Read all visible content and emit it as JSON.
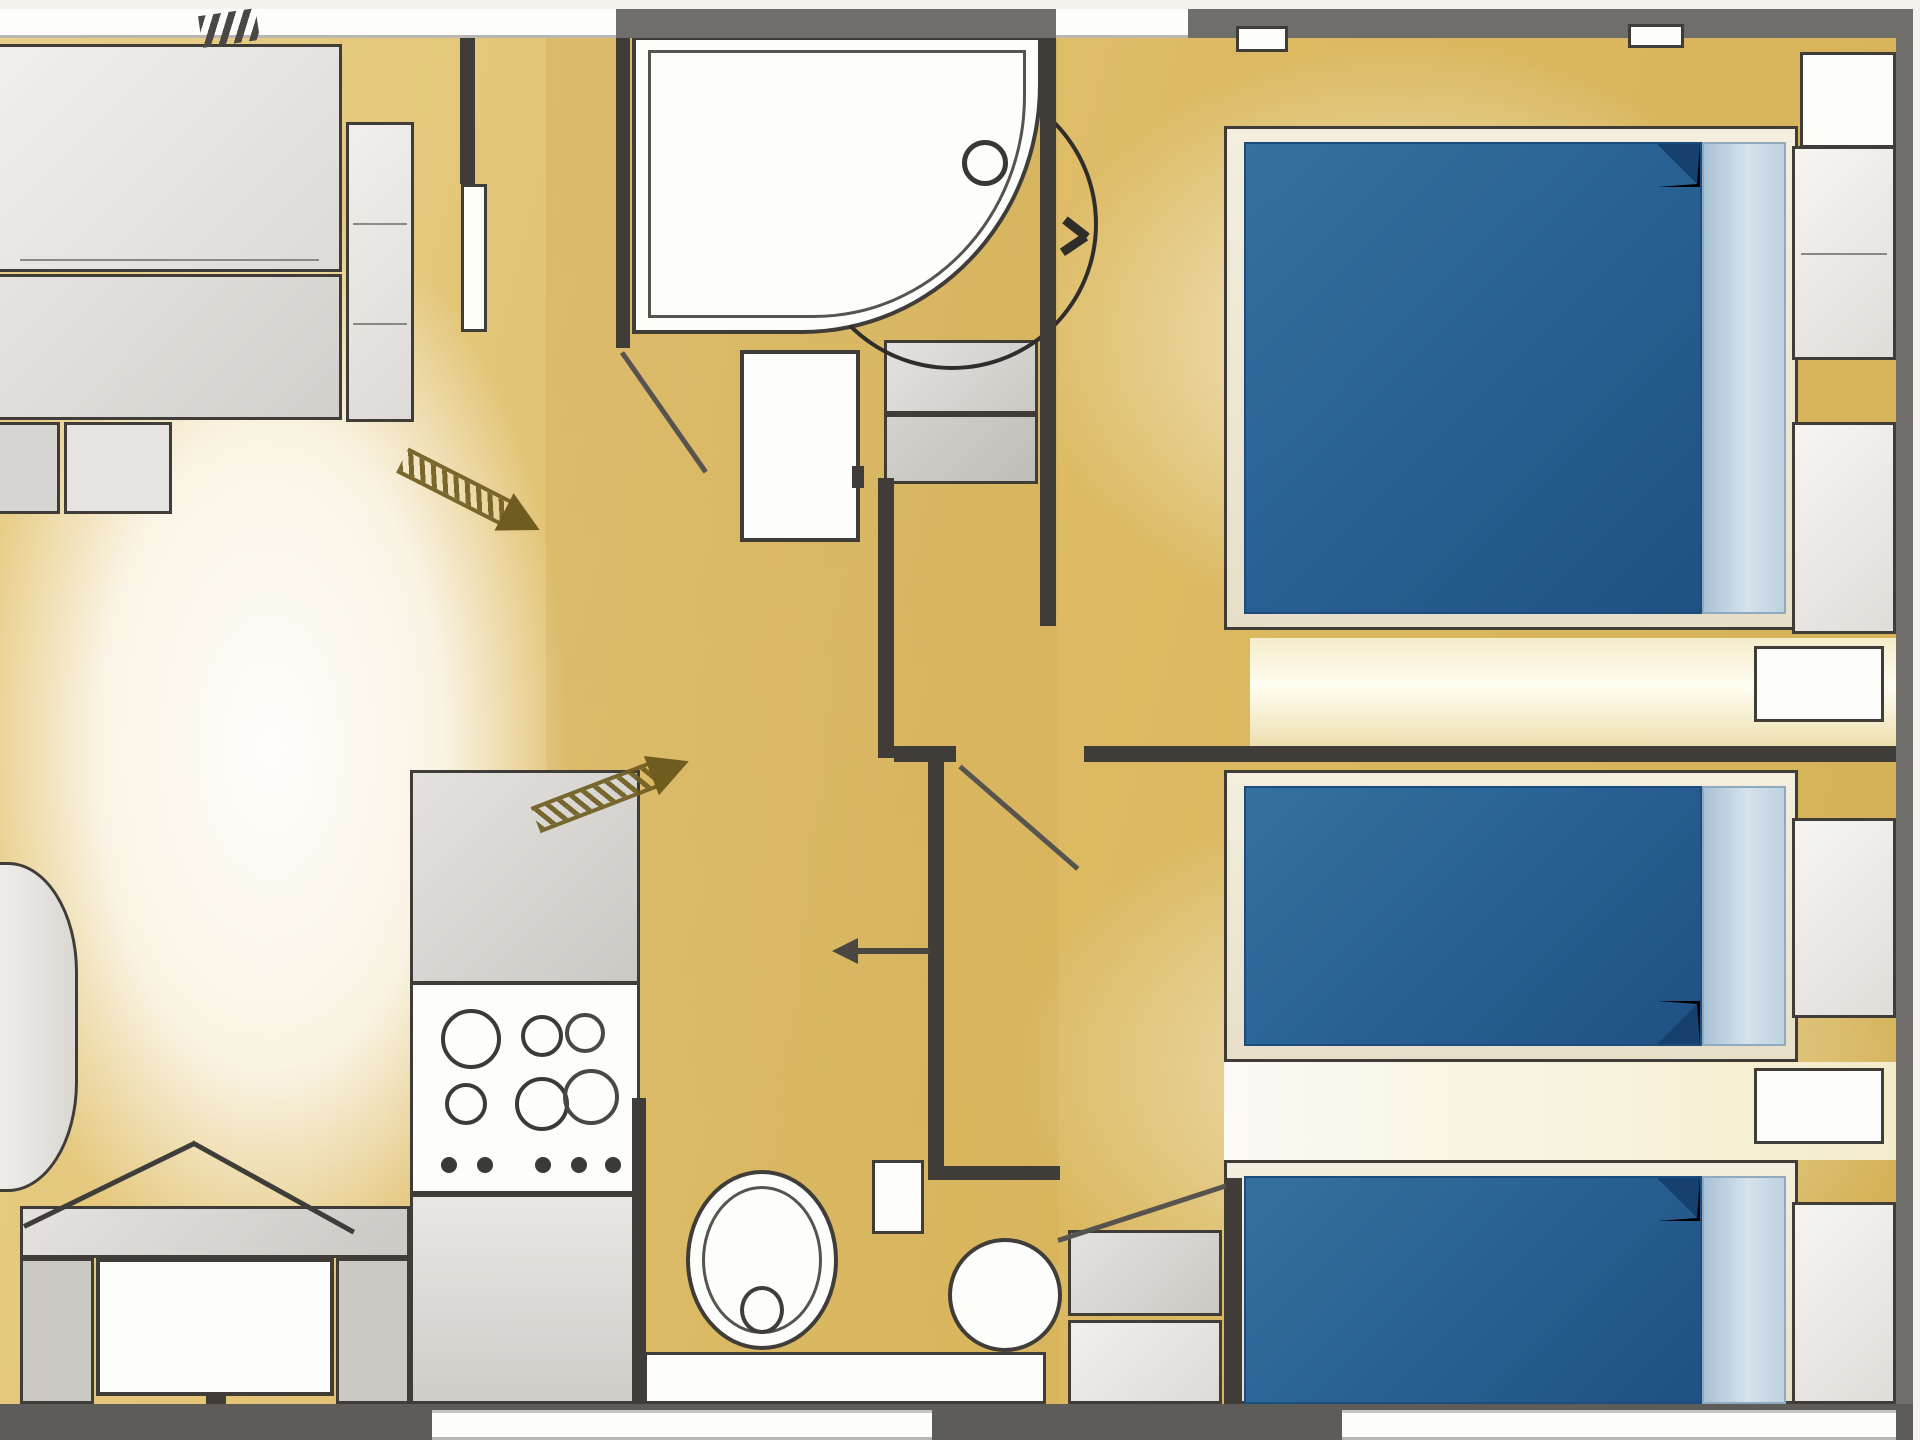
{
  "title": "mobile-home-floor-plan",
  "palette": {
    "floor_gold": "#d9b75f",
    "floor_gold_light": "#ecd28e",
    "floor_pale": "#f7f2e3",
    "wall_gray": "#6f6e6b",
    "wall_edge": "#f4f2ec",
    "ln": "#403d39",
    "ln_soft": "#57544f",
    "white": "#fdfdfc",
    "furn_light": "#eceae6",
    "furn_mid": "#dcdad6",
    "furn_dark": "#c6c4bf",
    "bed_blue": "#2a639b",
    "bed_blue_dark": "#1b4c80",
    "pillow": "#bccfe0",
    "pillow_light": "#d9e4ee",
    "cream": "#eee3b4",
    "arrow": "#6f5d20"
  },
  "legend": {
    "rooms": [
      "living-dining-area",
      "kitchen",
      "shower-room",
      "wc",
      "hallway",
      "double-bedroom",
      "twin-bedroom"
    ],
    "fixtures": [
      "sofa-bed",
      "wardrobe",
      "armchair",
      "dining-table",
      "bench-seat",
      "kitchen-counter",
      "hob-4-burner",
      "sink-unit",
      "corner-shower",
      "vanity-unit",
      "storage-shelves",
      "toilet",
      "washbasin",
      "double-bed",
      "single-bed",
      "single-bed",
      "nightstand",
      "entry-direction-arrow",
      "entry-direction-arrow"
    ]
  }
}
